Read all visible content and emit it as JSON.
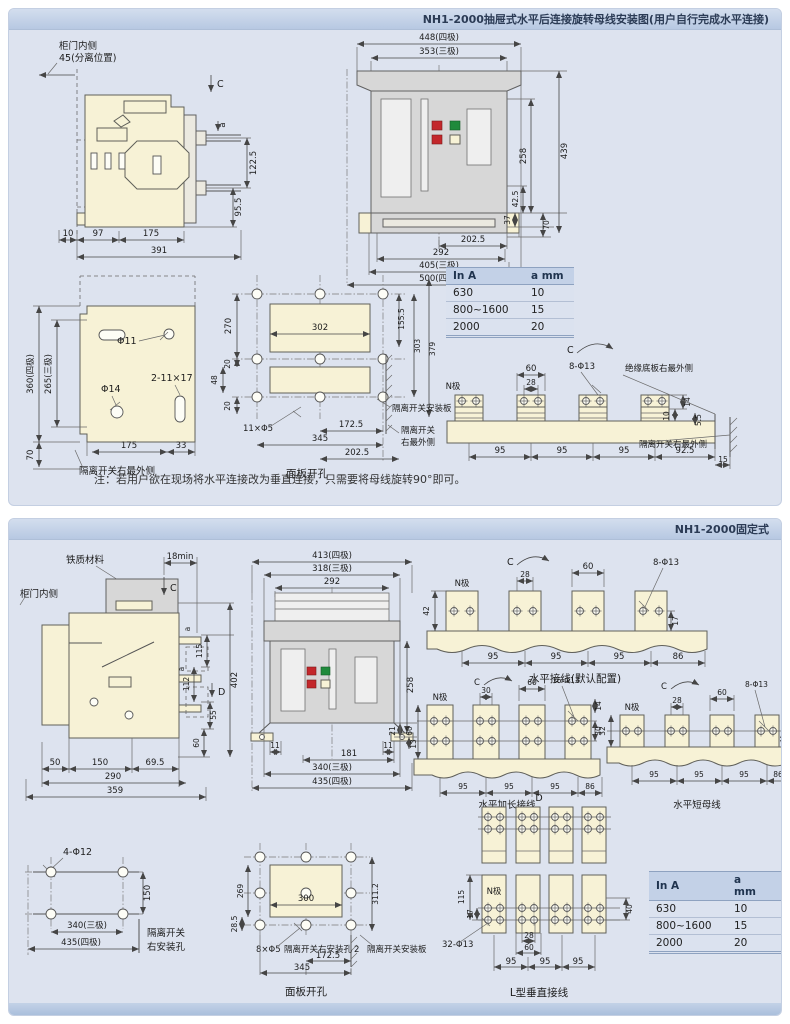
{
  "panel1": {
    "title": "NH1-2000抽屉式水平后连接旋转母线安装图(用户自行完成水平连接)",
    "note": "注：若用户欲在现场将水平连接改为垂直连接，只需要将母线旋转90°即可。",
    "side": {
      "door_label": "柜门内侧",
      "separation_label": "45(分离位置)",
      "c_label": "C",
      "a_label": "a",
      "dim_122_5": "122.5",
      "dim_95_5": "95.5",
      "dim_10": "10",
      "dim_97": "97",
      "dim_175": "175",
      "dim_391": "391"
    },
    "front": {
      "dim_448": "448(四极)",
      "dim_353": "353(三极)",
      "dim_258": "258",
      "dim_439": "439",
      "dim_42_5": "42.5",
      "dim_37": "37",
      "dim_70": "70",
      "dim_202_5": "202.5",
      "dim_292": "292",
      "dim_405": "405(三极)",
      "dim_500": "500(四极)"
    },
    "table": {
      "headers": [
        "In A",
        "a mm"
      ],
      "rows": [
        [
          "630",
          "10"
        ],
        [
          "800~1600",
          "15"
        ],
        [
          "2000",
          "20"
        ]
      ]
    },
    "plate": {
      "dim_360": "360(四极)",
      "dim_265": "265(三极)",
      "dim_70": "70",
      "dim_175": "175",
      "dim_33": "33",
      "hole_phi11": "Φ11",
      "hole_phi14": "Φ14",
      "slot": "2-11×17",
      "outer_label": "隔离开关右最外侧"
    },
    "cutout": {
      "caption": "面板开孔",
      "dim_270": "270",
      "dim_20a": "20",
      "dim_48": "48",
      "dim_20b": "20",
      "dim_302": "302",
      "dim_155_5": "155.5",
      "dim_303": "303",
      "dim_379": "379",
      "holes": "11×Φ5",
      "dim_172_5": "172.5",
      "dim_345": "345",
      "dim_202_5": "202.5",
      "mount_label": "隔离开关安装板",
      "outer_label_1": "隔离开关",
      "outer_label_2": "右最外侧"
    },
    "busbar": {
      "c_label": "C",
      "n_label": "N极",
      "dim_60": "60",
      "dim_28": "28",
      "holes": "8-Φ13",
      "dim_14": "14",
      "dim_10": "10",
      "dim_5_5": "5.5",
      "dim_95a": "95",
      "dim_95b": "95",
      "dim_95c": "95",
      "dim_92_5": "92.5",
      "dim_15": "15",
      "insulation_label": "绝缘底板右最外侧",
      "outer_label": "隔离开关右最外侧"
    }
  },
  "panel2": {
    "title": "NH1-2000固定式",
    "side": {
      "iron_label": "铁质材料",
      "door_label": "柜门内侧",
      "dim_18min": "18min",
      "c_label": "C",
      "d_label": "D",
      "a_label_1": "a",
      "a_label_2": "a",
      "dim_115": "115",
      "dim_402": "402",
      "dim_112": "112",
      "dim_55": "55",
      "dim_60": "60",
      "dim_50": "50",
      "dim_150": "150",
      "dim_69_5": "69.5",
      "dim_290": "290",
      "dim_359": "359"
    },
    "front": {
      "dim_413": "413(四极)",
      "dim_318": "318(三极)",
      "dim_292": "292",
      "dim_258": "258",
      "dim_21": "21",
      "dim_11a": "11",
      "dim_11b": "11",
      "dim_181": "181",
      "dim_13": "13",
      "dim_340": "340(三极)",
      "dim_435": "435(四极)"
    },
    "bus_default": {
      "caption": "水平接线(默认配置)",
      "c_label": "C",
      "n_label": "N极",
      "dim_28": "28",
      "dim_60": "60",
      "holes": "8-Φ13",
      "dim_42": "42",
      "dim_17": "17",
      "dim_95a": "95",
      "dim_95b": "95",
      "dim_95c": "95",
      "dim_86": "86"
    },
    "bus_long": {
      "caption": "水平加长接线",
      "c_label": "C",
      "n_label": "N极",
      "dim_30": "30",
      "dim_60": "60",
      "holes": "16-Φ13",
      "dim_60v": "60",
      "dim_14": "14",
      "dim_30v": "30",
      "dim_95a": "95",
      "dim_95b": "95",
      "dim_95c": "95",
      "dim_86": "86"
    },
    "bus_short": {
      "caption": "水平短母线",
      "c_label": "C",
      "n_label": "N极",
      "dim_28": "28",
      "dim_60": "60",
      "holes": "8-Φ13",
      "dim_32": "32",
      "b_label": "b",
      "dim_95a": "95",
      "dim_95b": "95",
      "dim_95c": "95",
      "dim_86": "86"
    },
    "mount": {
      "holes": "4-Φ12",
      "dim_150": "150",
      "dim_340": "340(三极)",
      "dim_435": "435(四极)",
      "label_1": "隔离开关",
      "label_2": "右安装孔"
    },
    "cutout": {
      "caption": "面板开孔",
      "dim_269": "269",
      "dim_28_5": "28.5",
      "dim_300": "300",
      "dim_311_2": "311.2",
      "holes": "8×Φ5",
      "right_hole_label": "隔离开关右安装孔",
      "dim_2": "2",
      "mount_label": "隔离开关安装板",
      "dim_172_5": "172.5",
      "dim_345": "345"
    },
    "bus_l": {
      "caption": "L型垂直接线",
      "d_label": "D",
      "n_label": "N极",
      "dim_115": "115",
      "dim_17": "17",
      "holes": "32-Φ13",
      "dim_28": "28",
      "dim_60": "60",
      "dim_40": "40",
      "dim_95a": "95",
      "dim_95b": "95",
      "dim_95c": "95"
    },
    "table": {
      "headers": [
        "In A",
        "a mm",
        "b mm"
      ],
      "rows": [
        [
          "630",
          "10",
          "17"
        ],
        [
          "800~1600",
          "15",
          "17"
        ],
        [
          "2000",
          "20",
          "18.5"
        ]
      ]
    }
  }
}
